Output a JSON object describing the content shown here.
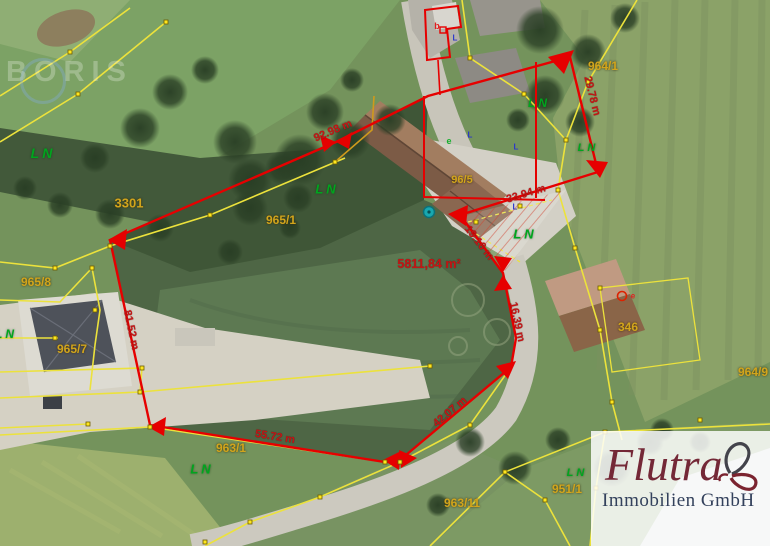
{
  "colors": {
    "boundary_red": "#e60000",
    "cadastral_yellow": "#ece23c",
    "label_yellow": "#d2a51c",
    "ln_green": "#00a51e",
    "measurement_red": "#c41414",
    "logo_maroon": "#742837",
    "logo_slate": "#33415c"
  },
  "map": {
    "watermark": "BORIS",
    "land_use_code": "LN",
    "area_label": {
      "text": "5811,84 m²",
      "x": 429,
      "y": 264
    },
    "parcel_labels": [
      {
        "text": "3301",
        "x": 129,
        "y": 203,
        "fs": 13
      },
      {
        "text": "965/1",
        "x": 281,
        "y": 220,
        "fs": 12
      },
      {
        "text": "964/1",
        "x": 603,
        "y": 66,
        "fs": 12
      },
      {
        "text": "96/5",
        "x": 462,
        "y": 180,
        "fs": 11
      },
      {
        "text": "965/7",
        "x": 72,
        "y": 349,
        "fs": 12
      },
      {
        "text": "965/8",
        "x": 36,
        "y": 282,
        "fs": 12
      },
      {
        "text": "346",
        "x": 628,
        "y": 327,
        "fs": 12
      },
      {
        "text": "963/1",
        "x": 231,
        "y": 448,
        "fs": 12
      },
      {
        "text": "963/11",
        "x": 462,
        "y": 503,
        "fs": 12
      },
      {
        "text": "951/1",
        "x": 567,
        "y": 489,
        "fs": 12
      },
      {
        "text": "964/9",
        "x": 753,
        "y": 372,
        "fs": 12
      }
    ],
    "ln_labels": [
      {
        "x": 43,
        "y": 153,
        "fs": 14
      },
      {
        "x": 327,
        "y": 189,
        "fs": 13
      },
      {
        "x": 539,
        "y": 103,
        "fs": 12
      },
      {
        "x": 588,
        "y": 148,
        "fs": 11
      },
      {
        "x": 525,
        "y": 234,
        "fs": 13
      },
      {
        "x": 202,
        "y": 469,
        "fs": 13
      },
      {
        "x": 577,
        "y": 473,
        "fs": 11
      },
      {
        "x": 6,
        "y": 334,
        "fs": 12
      }
    ],
    "measurements": [
      {
        "text": "92.98 m",
        "x": 333,
        "y": 131,
        "rot": -23
      },
      {
        "text": "29.78 m",
        "x": 592,
        "y": 96,
        "rot": 76
      },
      {
        "text": "33.94 m",
        "x": 526,
        "y": 194,
        "rot": -17
      },
      {
        "text": "19.16 m",
        "x": 479,
        "y": 243,
        "rot": 52
      },
      {
        "text": "16.39 m",
        "x": 517,
        "y": 322,
        "rot": 78
      },
      {
        "text": "42.07 m",
        "x": 450,
        "y": 412,
        "rot": -40
      },
      {
        "text": "55.72 m",
        "x": 275,
        "y": 437,
        "rot": 9
      },
      {
        "text": "81.52 m",
        "x": 131,
        "y": 330,
        "rot": 78
      }
    ],
    "marker_letters": [
      {
        "text": "b",
        "x": 437,
        "y": 26,
        "color": "#e02020",
        "fs": 9
      },
      {
        "text": "e",
        "x": 449,
        "y": 141,
        "color": "#18b030",
        "fs": 9
      },
      {
        "text": "e",
        "x": 633,
        "y": 296,
        "color": "#e02020",
        "fs": 8
      },
      {
        "text": "L",
        "x": 470,
        "y": 135,
        "color": "#2a35cc",
        "fs": 8
      },
      {
        "text": "L",
        "x": 516,
        "y": 147,
        "color": "#2a35cc",
        "fs": 8
      },
      {
        "text": "L",
        "x": 515,
        "y": 207,
        "color": "#2a35cc",
        "fs": 8
      },
      {
        "text": "L",
        "x": 455,
        "y": 38,
        "color": "#2a35cc",
        "fs": 8
      }
    ]
  },
  "logo": {
    "brand": "Flutra",
    "subtitle": "Immobilien GmbH"
  }
}
